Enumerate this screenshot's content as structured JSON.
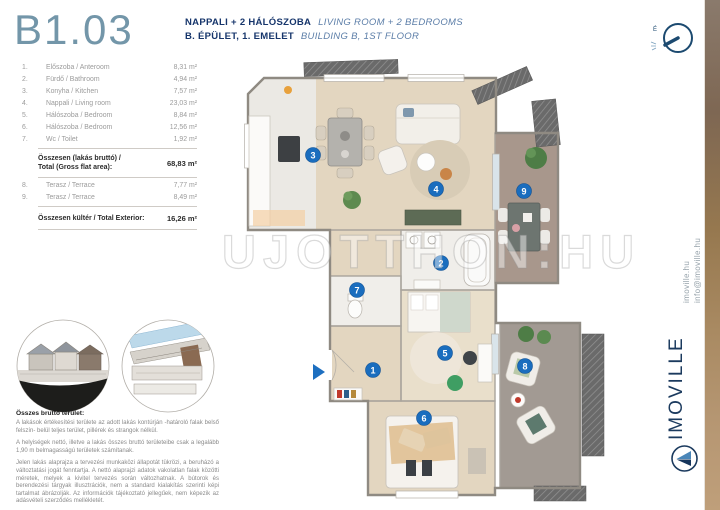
{
  "title": "B1.03",
  "header": {
    "hu_line1": "NAPPALI + 2 HÁLÓSZOBA",
    "en_line1": "LIVING ROOM + 2 BEDROOMS",
    "hu_line2": "B. ÉPÜLET, 1. EMELET",
    "en_line2": "BUILDING B, 1ST FLOOR"
  },
  "area_table": {
    "rows": [
      {
        "num": "1.",
        "name": "Előszoba / Anteroom",
        "area": "8,31 m²"
      },
      {
        "num": "2.",
        "name": "Fürdő / Bathroom",
        "area": "4,94 m²"
      },
      {
        "num": "3.",
        "name": "Konyha / Kitchen",
        "area": "7,57 m²"
      },
      {
        "num": "4.",
        "name": "Nappali / Living room",
        "area": "23,03 m²"
      },
      {
        "num": "5.",
        "name": "Hálószoba / Bedroom",
        "area": "8,84 m²"
      },
      {
        "num": "6.",
        "name": "Hálószoba / Bedroom",
        "area": "12,56 m²"
      },
      {
        "num": "7.",
        "name": "Wc / Toilet",
        "area": "1,92 m²"
      }
    ],
    "gross_total": {
      "label_hu": "Összesen (lakás bruttó) /",
      "label_en": "Total (Gross flat area):",
      "value": "68,83 m²"
    },
    "exterior_rows": [
      {
        "num": "8.",
        "name": "Terasz / Terrace",
        "area": "7,77 m²"
      },
      {
        "num": "9.",
        "name": "Terasz / Terrace",
        "area": "8,49 m²"
      }
    ],
    "exterior_total": {
      "label": "Összesen kültér / Total Exterior:",
      "value": "16,26 m²"
    }
  },
  "disclaimer": {
    "heading": "Összes bruttó terület:",
    "p1": "A lakások értékesítési területe az adott lakás kontúrján -határoló falak belső felszín- belül teljes terület, pillérek és strangok nélkül.",
    "p2": "A helyiségek nettó, illetve a lakás összes bruttó területeibe csak a legalább 1,90 m belmagasságú területek számítanak.",
    "p3": "Jelen lakás alaprajza a tervezési munkaközi állapotát tükrözi, a beruházó a változtatási jogát fenntartja. A nettó alaprajzi adatok vakolatlan falak közötti méretek, melyek a kivitel tervezés során változhatnak. A bútorok és berendezési tárgyak illusztrációk, nem a standard kialakítás szerinti képi tartalmat ábrázolják. Az információk tájékoztató jellegűek, nem képezik az adásvételi szerződés mellékletét."
  },
  "watermark": "UJOTTHON:HU",
  "floorplan": {
    "markers": [
      "1",
      "2",
      "3",
      "4",
      "5",
      "6",
      "7",
      "8",
      "9"
    ],
    "compass_label": "É"
  },
  "branding": {
    "website": "imoville.hu",
    "email": "info@imoville.hu",
    "logo": "IMOVILLE"
  },
  "colors": {
    "title_blue": "#7396a9",
    "navy": "#16356b",
    "marker_blue": "#1a6dbe",
    "wood_floor": "#e3d6c0",
    "terrace_brown": "#a8978c",
    "terrace_gray": "#a29a93",
    "wood_strip": "#a98a62"
  }
}
